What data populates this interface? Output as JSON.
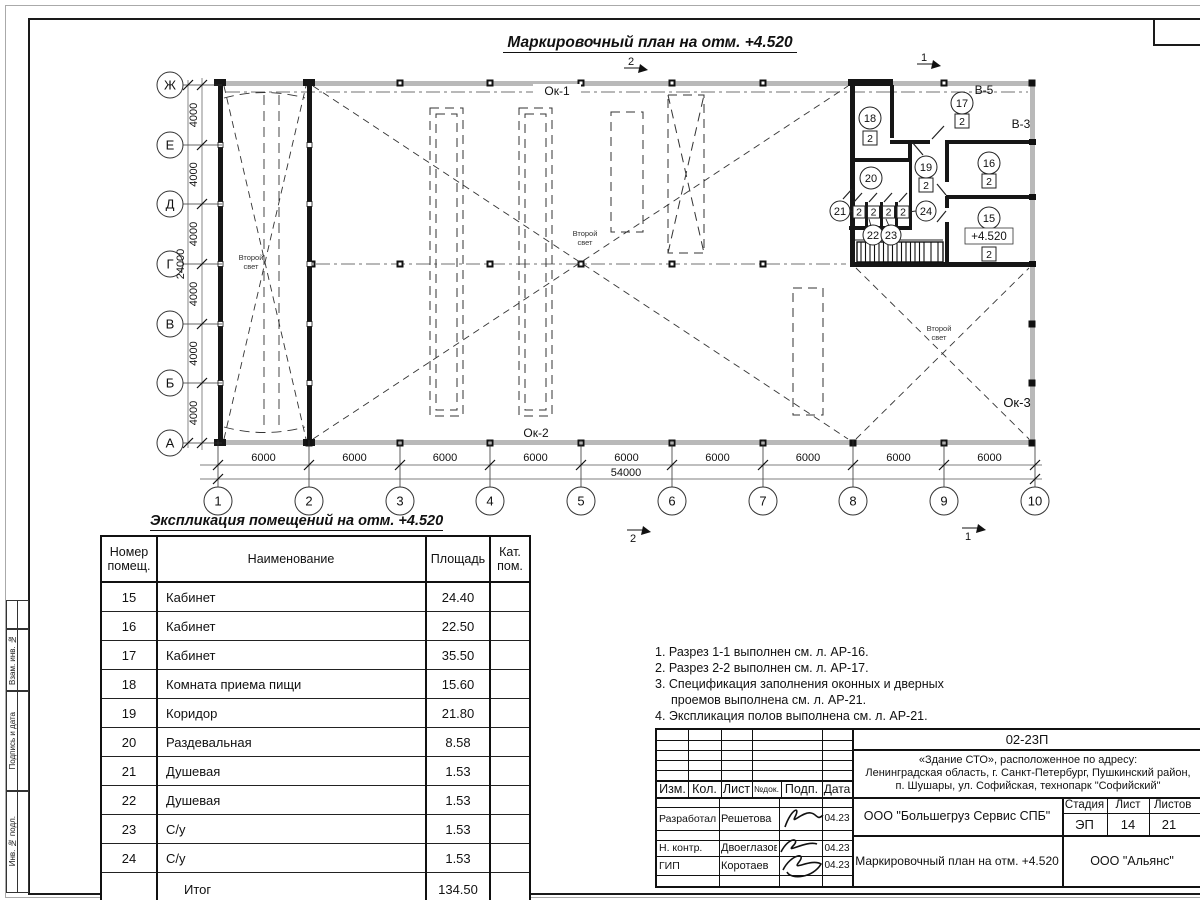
{
  "plan": {
    "title": "Маркировочный план на отм. +4.520",
    "axes_letters": [
      "Ж",
      "Е",
      "Д",
      "Г",
      "В",
      "Б",
      "А"
    ],
    "axes_numbers": [
      "1",
      "2",
      "3",
      "4",
      "5",
      "6",
      "7",
      "8",
      "9",
      "10"
    ],
    "dims_h": [
      "6000",
      "6000",
      "6000",
      "6000",
      "6000",
      "6000",
      "6000",
      "6000",
      "6000"
    ],
    "dim_h_total": "54000",
    "dims_v": [
      "4000",
      "4000",
      "4000",
      "4000",
      "4000",
      "4000"
    ],
    "dim_v_total": "24000",
    "window_labels": {
      "ok1": "Ок-1",
      "ok2": "Ок-2",
      "ok3": "Ок-3",
      "v5": "В-5",
      "v3": "В-3"
    },
    "second_light_line1": "Второй",
    "second_light_line2": "свет",
    "elevation_mark": "+4.520",
    "category_mark": "2",
    "room_numbers": [
      "15",
      "16",
      "17",
      "18",
      "19",
      "20",
      "21",
      "22",
      "23",
      "24"
    ],
    "section_marks": {
      "top_left": "2",
      "top_right": "1",
      "bottom_left": "2",
      "bottom_right": "1"
    }
  },
  "schedule": {
    "title": "Экспликация помещений на отм. +4.520",
    "headers": [
      "Номер помещ.",
      "Наименование",
      "Площадь",
      "Кат. пом."
    ],
    "rows": [
      [
        "15",
        "Кабинет",
        "24.40"
      ],
      [
        "16",
        "Кабинет",
        "22.50"
      ],
      [
        "17",
        "Кабинет",
        "35.50"
      ],
      [
        "18",
        "Комната приема пищи",
        "15.60"
      ],
      [
        "19",
        "Коридор",
        "21.80"
      ],
      [
        "20",
        "Раздевальная",
        "8.58"
      ],
      [
        "21",
        "Душевая",
        "1.53"
      ],
      [
        "22",
        "Душевая",
        "1.53"
      ],
      [
        "23",
        "С/у",
        "1.53"
      ],
      [
        "24",
        "С/у",
        "1.53"
      ]
    ],
    "total_label": "Итог",
    "total_value": "134.50"
  },
  "notes": {
    "lines": [
      "1. Разрез 1-1 выполнен см. л. АР-16.",
      "2. Разрез 2-2 выполнен см. л. АР-17.",
      "3. Спецификация заполнения оконных и дверных",
      "проемов выполнена см. л. АР-21.",
      "4. Экспликация полов выполнена см. л. АР-21."
    ]
  },
  "titleblock": {
    "doc_code": "02-23П",
    "address_lines": [
      "«Здание СТО», расположенное по адресу:",
      "Ленинградская область, г. Санкт-Петербург, Пушкинский район,",
      "п. Шушары, ул. Софийская, технопарк \"Софийский\""
    ],
    "columns": [
      "Изм.",
      "Кол.",
      "Лист",
      "№док.",
      "Подп.",
      "Дата"
    ],
    "staff": [
      {
        "role": "Разработал",
        "name": "Решетова",
        "date": "04.23"
      },
      {
        "role": "Н. контр.",
        "name": "Двоеглазов",
        "date": "04.23"
      },
      {
        "role": "ГИП",
        "name": "Коротаев",
        "date": "04.23"
      }
    ],
    "org": "ООО \"Большегруз Сервис СПБ\"",
    "doc_title": "Маркировочный план на отм. +4.520",
    "org2": "ООО \"Альянс\"",
    "stage_label": "Стадия",
    "sheet_label": "Лист",
    "sheets_label": "Листов",
    "stage": "ЭП",
    "sheet_num": "14",
    "sheets_total": "21"
  },
  "frame": {
    "side_labels": [
      "Взам. инв. №",
      "Подпись и дата",
      "Инв. № подл."
    ]
  }
}
